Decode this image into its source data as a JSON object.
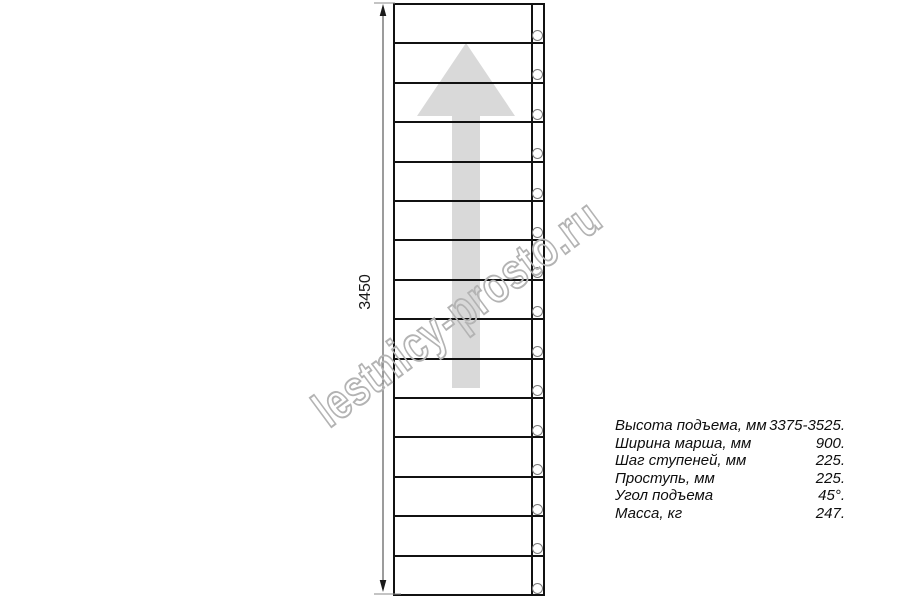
{
  "watermark": {
    "text": "lestnicy-prosto.ru",
    "color": "#b3b3b3"
  },
  "drawing": {
    "dimension_label": "3450",
    "steps_count": 15,
    "arrow_color": "#d9d9d9",
    "line_color": "#111111",
    "dim_line_color": "#666666"
  },
  "specs": {
    "rows": [
      {
        "label": "Высота подъема, мм",
        "value": "3375-3525."
      },
      {
        "label": "Ширина марша, мм",
        "value": "900."
      },
      {
        "label": "Шаг ступеней, мм",
        "value": "225."
      },
      {
        "label": "Проступь, мм",
        "value": "225."
      },
      {
        "label": "Угол подъема",
        "value": "45°."
      },
      {
        "label": "Масса, кг",
        "value": "247."
      }
    ]
  }
}
